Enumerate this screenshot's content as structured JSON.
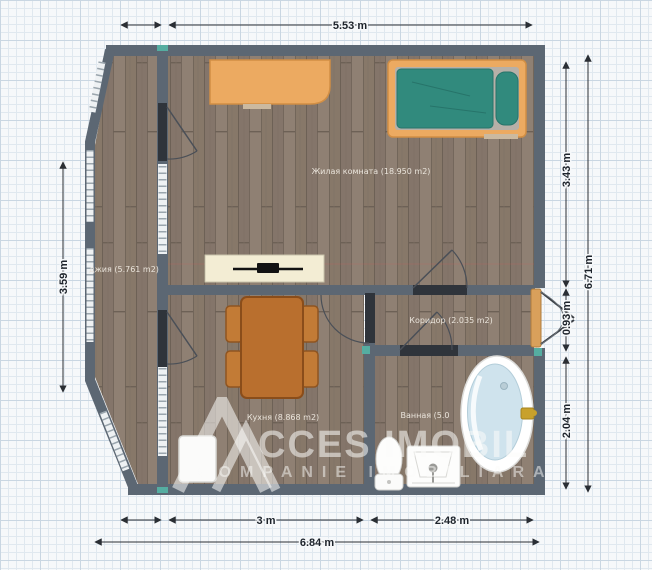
{
  "plan": {
    "type": "apartment-floor-plan",
    "units": "m"
  },
  "rooms": {
    "living": {
      "label": "Жилая комната (18.950 m2)"
    },
    "balcony": {
      "label": "джия (5.761 m2)"
    },
    "kitchen": {
      "label": "Кухня (8.868 m2)"
    },
    "corridor": {
      "label": "Коридор (2.035 m2)"
    },
    "bathroom": {
      "label": "Ванная (5.0"
    }
  },
  "dimensions": {
    "top": "5.53 m",
    "left": "3.59 m",
    "right_living": "3.43 m",
    "right_entry": "0.93 m",
    "right_bath": "2.04 m",
    "right_total": "6.71 m",
    "bottom_kitchen": "3 m",
    "bottom_bath": "2.48 m",
    "bottom_total": "6.84 m"
  },
  "watermark": {
    "brand": "ACCES IMOBIL",
    "brand_rest": "CCES IMOBIL",
    "tagline": "COMPANIE IMOBILIARA"
  },
  "colors": {
    "wall": "#5c6773",
    "floor_wood": "#8a7b6e",
    "door_header": "#2f343b",
    "teal_accent": "#55ada1",
    "furniture_orange": "#ecaa61",
    "mattress_teal": "#318a7d",
    "table_brown": "#b96f2e",
    "tub_blue": "#cfe3ed",
    "entrance_door_tan": "#d9a05b",
    "dimension_text": "#1d232b",
    "grid_line": "#c9d6e2"
  }
}
